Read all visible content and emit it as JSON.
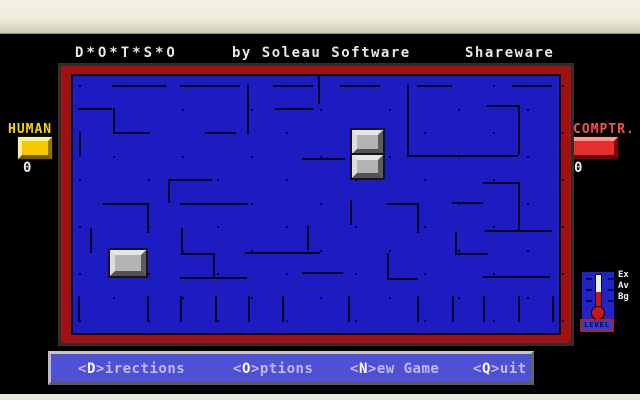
{
  "header": {
    "title": "D*O*T*S*O",
    "subtitle": "by Soleau Software",
    "license": "Shareware"
  },
  "players": {
    "human": {
      "label": "HUMAN",
      "score": "0"
    },
    "computer": {
      "label": "COMPTR.",
      "score": "0"
    }
  },
  "colors": {
    "board_blue": "#1c1cc0",
    "board_border_red": "#a31010",
    "wall": "#000020",
    "menu_blue": "#5050d4",
    "human_gold": "#f5c800",
    "computer_red": "#e62e2e"
  },
  "board": {
    "grid": {
      "x0": 7.5,
      "y0": 11,
      "dx": 34.5,
      "dy": 23.5,
      "cols": 15,
      "rows": 11,
      "dot_pattern": "checkerboard"
    },
    "walls": [
      [
        41,
        11,
        95,
        11
      ],
      [
        109,
        11,
        169,
        11
      ],
      [
        202,
        11,
        242,
        11
      ],
      [
        269,
        11,
        309,
        11
      ],
      [
        346,
        11,
        381,
        11
      ],
      [
        441,
        11,
        481,
        11
      ],
      [
        7,
        34,
        41,
        34
      ],
      [
        204,
        34,
        242,
        34
      ],
      [
        416,
        31,
        447,
        31
      ],
      [
        42,
        58,
        77,
        58
      ],
      [
        134,
        58,
        165,
        58
      ],
      [
        336,
        81,
        447,
        81
      ],
      [
        231,
        84,
        274,
        84
      ],
      [
        99,
        105,
        141,
        105
      ],
      [
        412,
        108,
        447,
        108
      ],
      [
        381,
        128,
        412,
        128
      ],
      [
        316,
        129,
        347,
        129
      ],
      [
        32,
        129,
        76,
        129
      ],
      [
        109,
        129,
        177,
        129
      ],
      [
        414,
        156,
        481,
        156
      ],
      [
        174,
        178,
        249,
        178
      ],
      [
        384,
        179,
        417,
        179
      ],
      [
        110,
        179,
        142,
        179
      ],
      [
        231,
        198,
        272,
        198
      ],
      [
        412,
        202,
        479,
        202
      ],
      [
        109,
        203,
        176,
        203
      ],
      [
        316,
        204,
        347,
        204
      ],
      [
        176,
        11,
        176,
        60
      ],
      [
        247,
        0,
        247,
        30
      ],
      [
        42,
        34,
        42,
        58
      ],
      [
        8,
        58,
        8,
        82
      ],
      [
        336,
        11,
        336,
        81
      ],
      [
        447,
        31,
        447,
        81
      ],
      [
        97,
        105,
        97,
        129
      ],
      [
        279,
        126,
        279,
        151
      ],
      [
        346,
        129,
        346,
        159
      ],
      [
        76,
        129,
        76,
        159
      ],
      [
        19,
        154,
        19,
        179
      ],
      [
        110,
        154,
        110,
        179
      ],
      [
        236,
        152,
        236,
        176
      ],
      [
        384,
        158,
        384,
        179
      ],
      [
        142,
        179,
        142,
        203
      ],
      [
        316,
        179,
        316,
        204
      ],
      [
        447,
        108,
        447,
        156
      ],
      [
        7,
        222,
        7,
        248
      ],
      [
        76,
        222,
        76,
        248
      ],
      [
        109,
        222,
        109,
        248
      ],
      [
        144,
        222,
        144,
        248
      ],
      [
        177,
        222,
        177,
        248
      ],
      [
        211,
        222,
        211,
        248
      ],
      [
        277,
        222,
        277,
        248
      ],
      [
        346,
        222,
        346,
        248
      ],
      [
        381,
        222,
        381,
        248
      ],
      [
        412,
        222,
        412,
        248
      ],
      [
        447,
        222,
        447,
        248
      ],
      [
        481,
        222,
        481,
        248
      ]
    ],
    "pieces": [
      {
        "x": 281,
        "y": 56,
        "w": 31,
        "h": 24
      },
      {
        "x": 281,
        "y": 81,
        "w": 31,
        "h": 23
      },
      {
        "x": 39,
        "y": 176,
        "w": 36,
        "h": 26
      }
    ]
  },
  "level_panel": {
    "label": "LEVEL",
    "levels": [
      "Ex",
      "Av",
      "Bg"
    ]
  },
  "menu": {
    "items": [
      {
        "key": "D",
        "rest": "irections"
      },
      {
        "key": "O",
        "rest": "ptions"
      },
      {
        "key": "N",
        "rest": "ew Game"
      },
      {
        "key": "Q",
        "rest": "uit"
      }
    ]
  }
}
